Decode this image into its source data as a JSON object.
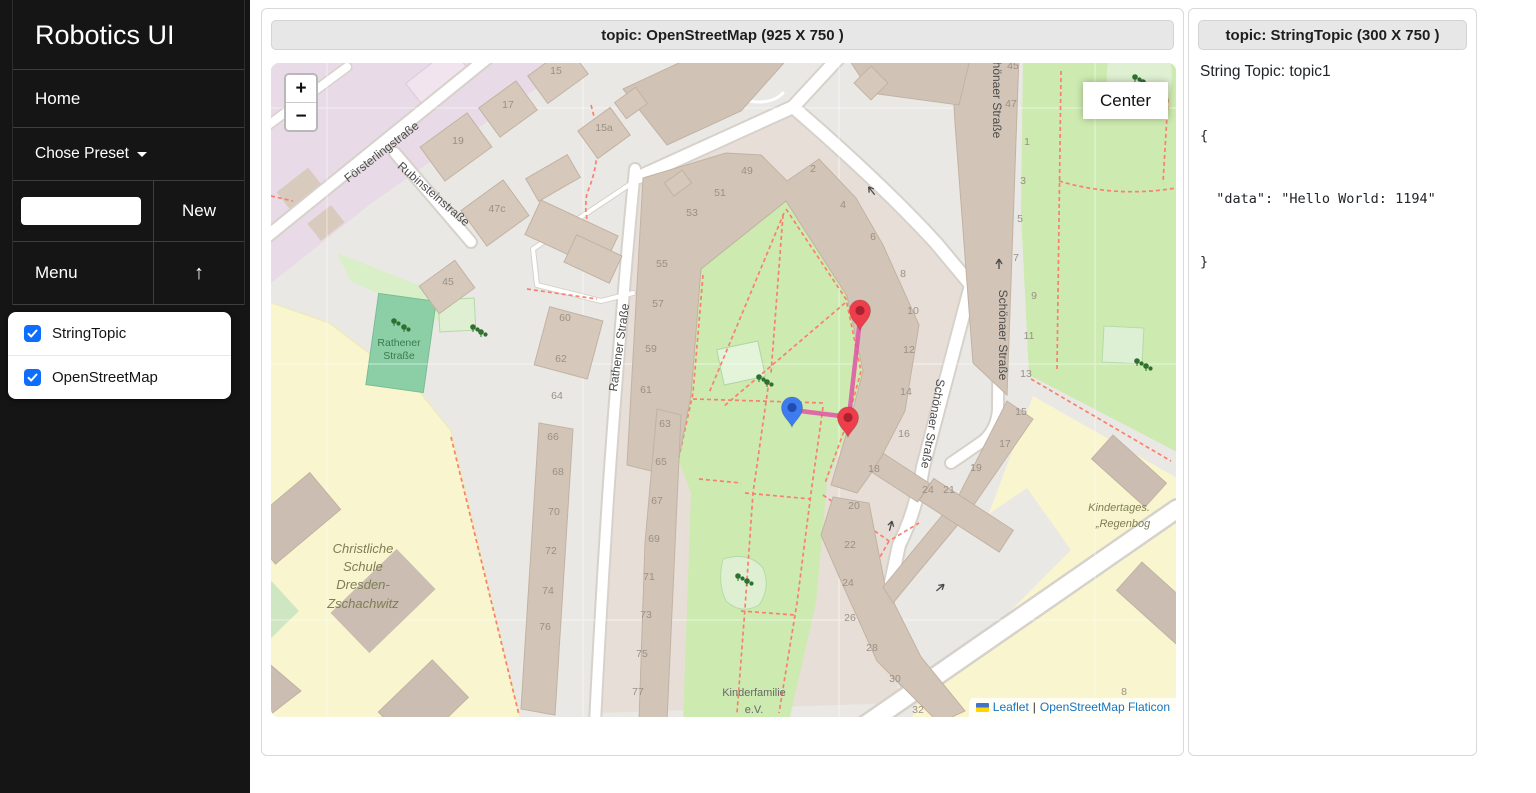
{
  "sidebar": {
    "title": "Robotics UI",
    "home_label": "Home",
    "preset_label": "Chose Preset",
    "preset_input_value": "",
    "new_button": "New",
    "menu_label": "Menu",
    "up_arrow": "↑",
    "topics": [
      {
        "label": "StringTopic",
        "checked": true
      },
      {
        "label": "OpenStreetMap",
        "checked": true
      }
    ]
  },
  "map_panel": {
    "header": "topic: OpenStreetMap (925 X 750 )",
    "zoom_in": "+",
    "zoom_out": "−",
    "center_button": "Center",
    "attribution": {
      "leaflet": "Leaflet",
      "sep": "|",
      "osm": "OpenStreetMap Flaticon"
    }
  },
  "string_panel": {
    "header": "topic: StringTopic (300 X 750 )",
    "topic_line": "String Topic: topic1",
    "json_lines": [
      "{",
      "  \"data\": \"Hello World: 1194\"",
      "}"
    ]
  },
  "map": {
    "street_labels": [
      {
        "text": "Försterlingstraße",
        "x": 113,
        "y": 92,
        "rot": -38,
        "cls": "street"
      },
      {
        "text": "Rubinsteinstraße",
        "x": 160,
        "y": 134,
        "rot": 41,
        "cls": "street"
      },
      {
        "text": "Rathener Straße",
        "x": 352,
        "y": 285,
        "rot": -82,
        "cls": "street"
      },
      {
        "text": "Schönaer Straße",
        "x": 722,
        "y": 30,
        "rot": 90,
        "cls": "street"
      },
      {
        "text": "Schönaer Straße",
        "x": 728,
        "y": 272,
        "rot": 90,
        "cls": "street"
      },
      {
        "text": "Schönaer Straße",
        "x": 658,
        "y": 360,
        "rot": 100,
        "cls": "street"
      }
    ],
    "area_labels": [
      {
        "text": "Rathener",
        "x": 128,
        "y": 283,
        "cls": "teal"
      },
      {
        "text": "Straße",
        "x": 128,
        "y": 296,
        "cls": "teal"
      },
      {
        "text": "Christliche",
        "x": 92,
        "y": 490,
        "cls": "olive"
      },
      {
        "text": "Schule",
        "x": 92,
        "y": 508,
        "cls": "olive"
      },
      {
        "text": "Dresden-",
        "x": 92,
        "y": 526,
        "cls": "olive"
      },
      {
        "text": "Zschachwitz",
        "x": 92,
        "y": 545,
        "cls": "olive"
      },
      {
        "text": "Kindertages.",
        "x": 848,
        "y": 448,
        "cls": "olive-sm"
      },
      {
        "text": "„Regenbog",
        "x": 852,
        "y": 464,
        "cls": "olive-sm"
      },
      {
        "text": "Kinderfamilie",
        "x": 483,
        "y": 633,
        "cls": "graylbl"
      },
      {
        "text": "e.V.",
        "x": 483,
        "y": 650,
        "cls": "graylbl"
      }
    ],
    "house_numbers": [
      [
        "15",
        285,
        11
      ],
      [
        "17",
        237,
        45
      ],
      [
        "19",
        187,
        81
      ],
      [
        "15a",
        333,
        68
      ],
      [
        "47c",
        226,
        149
      ],
      [
        "45",
        177,
        222
      ],
      [
        "49",
        476,
        111
      ],
      [
        "51",
        449,
        133
      ],
      [
        "53",
        421,
        153
      ],
      [
        "55",
        391,
        204
      ],
      [
        "57",
        387,
        244
      ],
      [
        "59",
        380,
        289
      ],
      [
        "61",
        375,
        330
      ],
      [
        "63",
        394,
        364
      ],
      [
        "65",
        390,
        402
      ],
      [
        "67",
        386,
        441
      ],
      [
        "69",
        383,
        479
      ],
      [
        "71",
        378,
        517
      ],
      [
        "73",
        375,
        555
      ],
      [
        "75",
        371,
        594
      ],
      [
        "77",
        367,
        632
      ],
      [
        "60",
        294,
        258
      ],
      [
        "62",
        290,
        299
      ],
      [
        "64",
        286,
        336
      ],
      [
        "66",
        282,
        377
      ],
      [
        "68",
        287,
        412
      ],
      [
        "70",
        283,
        452
      ],
      [
        "72",
        280,
        491
      ],
      [
        "74",
        277,
        531
      ],
      [
        "76",
        274,
        567
      ],
      [
        "2",
        542,
        109
      ],
      [
        "4",
        572,
        145
      ],
      [
        "6",
        602,
        177
      ],
      [
        "8",
        632,
        214
      ],
      [
        "10",
        642,
        251
      ],
      [
        "12",
        638,
        290
      ],
      [
        "14",
        635,
        332
      ],
      [
        "16",
        633,
        374
      ],
      [
        "18",
        603,
        409
      ],
      [
        "20",
        583,
        446
      ],
      [
        "22",
        579,
        485
      ],
      [
        "24",
        577,
        523
      ],
      [
        "26",
        579,
        558
      ],
      [
        "28",
        601,
        588
      ],
      [
        "30",
        624,
        619
      ],
      [
        "32",
        647,
        650
      ],
      [
        "24",
        657,
        430
      ],
      [
        "45",
        742,
        6
      ],
      [
        "47",
        740,
        44
      ],
      [
        "1",
        756,
        82
      ],
      [
        "3",
        752,
        121
      ],
      [
        "5",
        749,
        159
      ],
      [
        "7",
        745,
        198
      ],
      [
        "9",
        763,
        236
      ],
      [
        "11",
        758,
        276
      ],
      [
        "13",
        755,
        314
      ],
      [
        "15",
        750,
        352
      ],
      [
        "17",
        734,
        384
      ],
      [
        "19",
        705,
        408
      ],
      [
        "21",
        678,
        430
      ],
      [
        "8",
        853,
        632
      ]
    ],
    "trees": [
      [
        123,
        258
      ],
      [
        133,
        264
      ],
      [
        202,
        264
      ],
      [
        210,
        269
      ],
      [
        488,
        314
      ],
      [
        496,
        319
      ],
      [
        467,
        513
      ],
      [
        476,
        518
      ],
      [
        866,
        298
      ],
      [
        875,
        303
      ],
      [
        864,
        14
      ],
      [
        872,
        19
      ]
    ],
    "arrows": [
      [
        728,
        200,
        0
      ],
      [
        600,
        127,
        -38
      ],
      [
        620,
        462,
        15
      ],
      [
        670,
        524,
        50
      ]
    ],
    "markers": {
      "pins": [
        {
          "color": "#ee3e4b",
          "inner": "#a8222f",
          "x": 589,
          "y": 267
        },
        {
          "color": "#ee3e4b",
          "inner": "#a8222f",
          "x": 577,
          "y": 374
        },
        {
          "color": "#3e7bf0",
          "inner": "#1f4db0",
          "x": 521,
          "y": 364
        }
      ],
      "route": {
        "points": [
          [
            589,
            256
          ],
          [
            578,
            354
          ],
          [
            521,
            347
          ]
        ],
        "color": "#e154a5"
      }
    }
  },
  "colors": {
    "sidebar_bg": "#151515",
    "checkbox_blue": "#0d6efd",
    "header_bg": "#e7e7e7",
    "park_green": "#cdeab0",
    "building_tan": "#d2c5b7",
    "path_dash_red": "#f8806f",
    "marker_red": "#ee3e4b",
    "marker_blue": "#3e7bf0",
    "route_pink": "#e154a5",
    "attr_link_blue": "#1673c0"
  }
}
